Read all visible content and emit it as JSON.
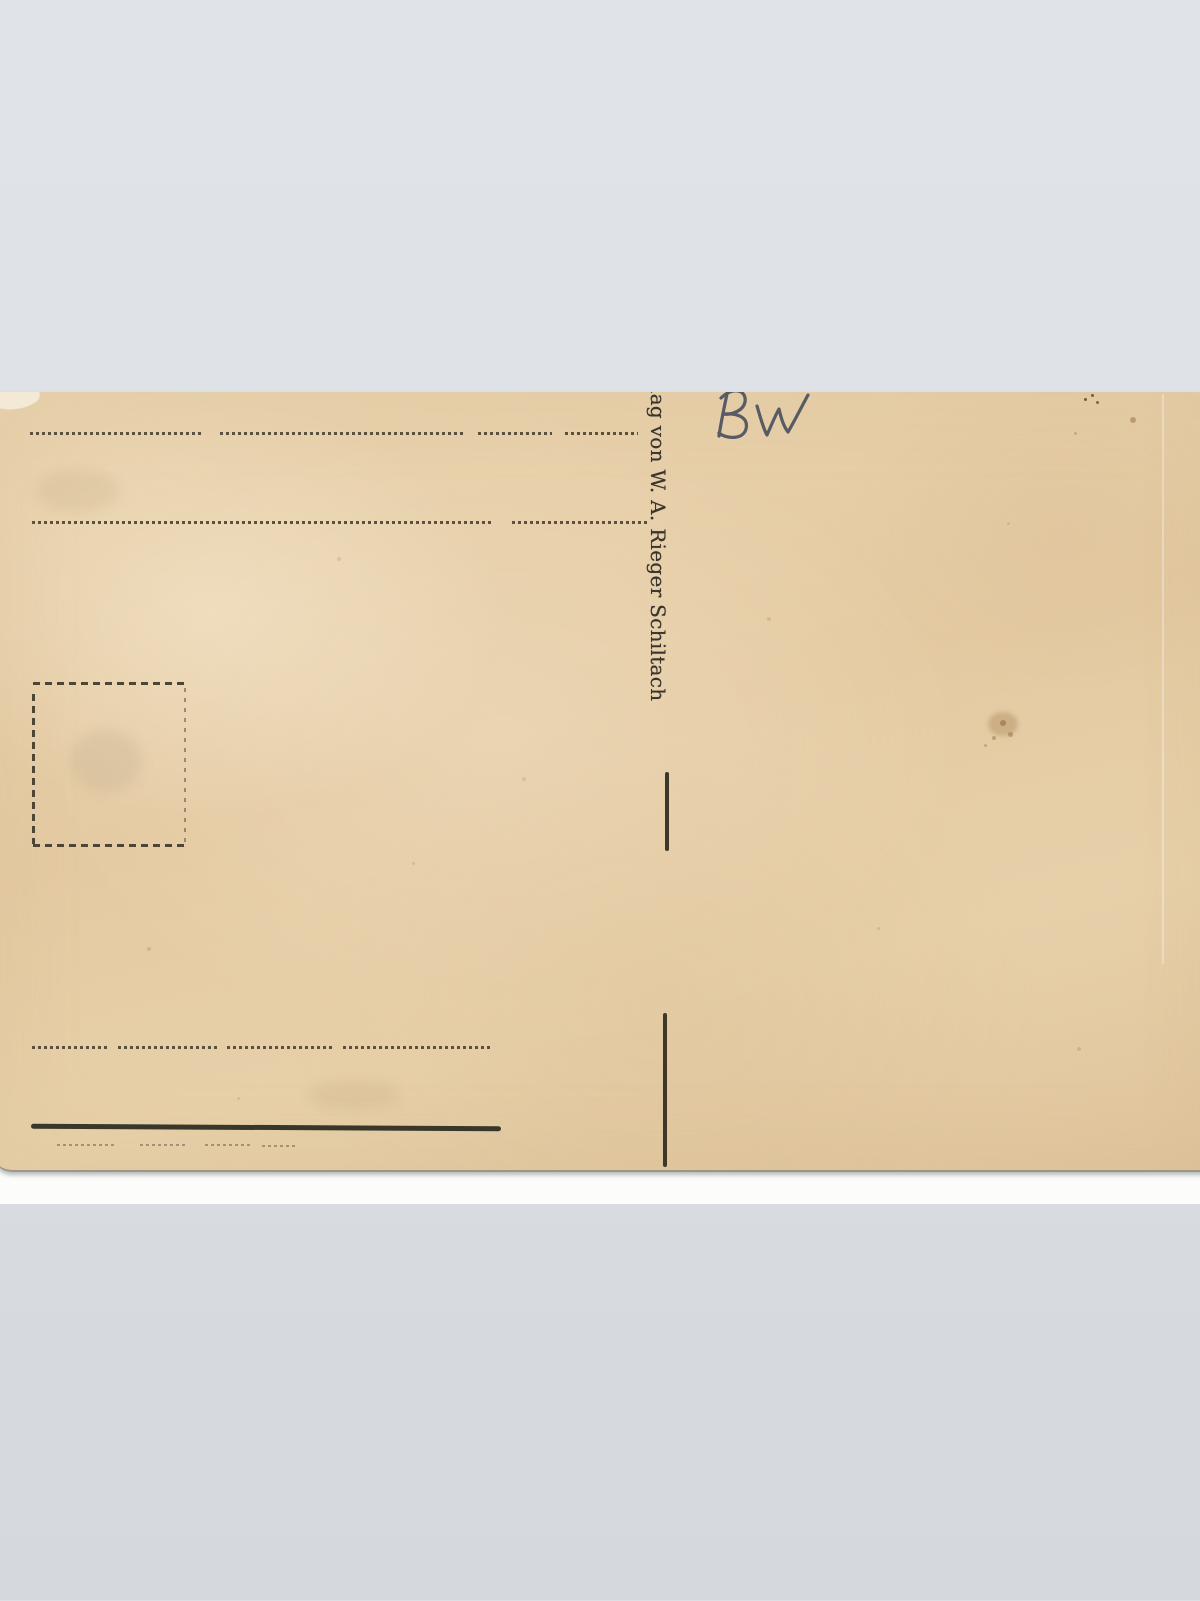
{
  "scan": {
    "backdrop_color": "#dde1e6",
    "scanner_bed_color": "#fcfcfa"
  },
  "postcard": {
    "paper_color": "#e6cfa8",
    "print_ink_color": "#3c372c",
    "imprint_text": "lag von W. A. Rieger Schiltach",
    "handwritten_note": "BW",
    "pencil_color": "#565b64",
    "features": {
      "address_lines": 2,
      "message_lines": 1,
      "stamp_box": "dashed square outline",
      "column_divider": "two short vertical strokes",
      "signature_underline": "heavy dark rule with faint dashed line below"
    }
  }
}
